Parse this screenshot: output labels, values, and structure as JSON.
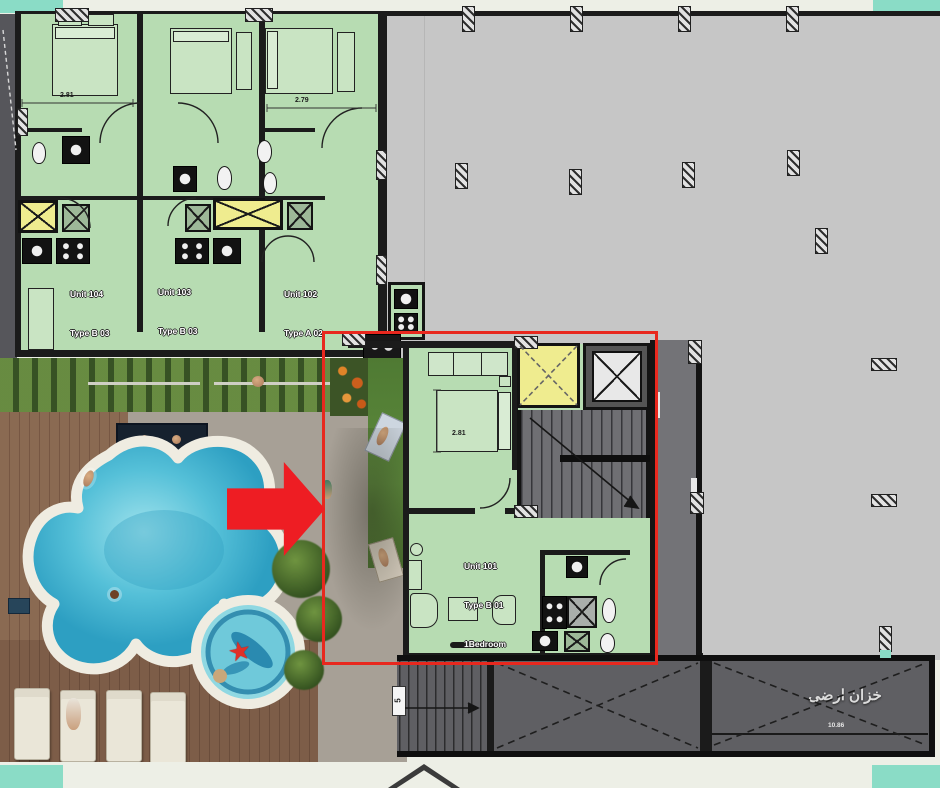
{
  "units": [
    {
      "name": "Unit 104",
      "type_line": "Type B 03",
      "bedroom_line": "1Bedroom",
      "area_line": "Area 40 m2",
      "garden_line": "4 m2 GR"
    },
    {
      "name": "Unit 103",
      "type_line": "Type B 03",
      "bedroom_line": "1Bedroom",
      "area_line": "Area 40 m2",
      "garden_line": "4 m2 GR"
    },
    {
      "name": "Unit 102",
      "type_line": "Type A 02",
      "bedroom_line": "1Bedroom",
      "area_line": "Area 46 m2",
      "garden_line": "5 m2 GR"
    },
    {
      "name": "Unit 101",
      "type_line": "Type B 01",
      "bedroom_line": "1Bedroom",
      "area_line": "Area 50 m2",
      "garden_line": "7 m2 GR"
    }
  ],
  "dimensions": {
    "unit104_bedroom": "2.81",
    "unit102_bedroom": "2.79",
    "unit101_bedroom": "2.81"
  },
  "annotations": {
    "tank_label_ar": "خزان ارضى",
    "tank_dim": "10.86",
    "ramp_label": "5"
  },
  "colors": {
    "unit_fill": "#b7dcb2",
    "slab_fill": "#c6c6c6",
    "shaft_yellow": "#efec8f",
    "highlight_red": "#e8281e",
    "teal_corner": "#8adcc6",
    "pool_water": "#3fb4d2",
    "tank_gray": "#5f5f63",
    "wood_deck": "#86664f"
  }
}
